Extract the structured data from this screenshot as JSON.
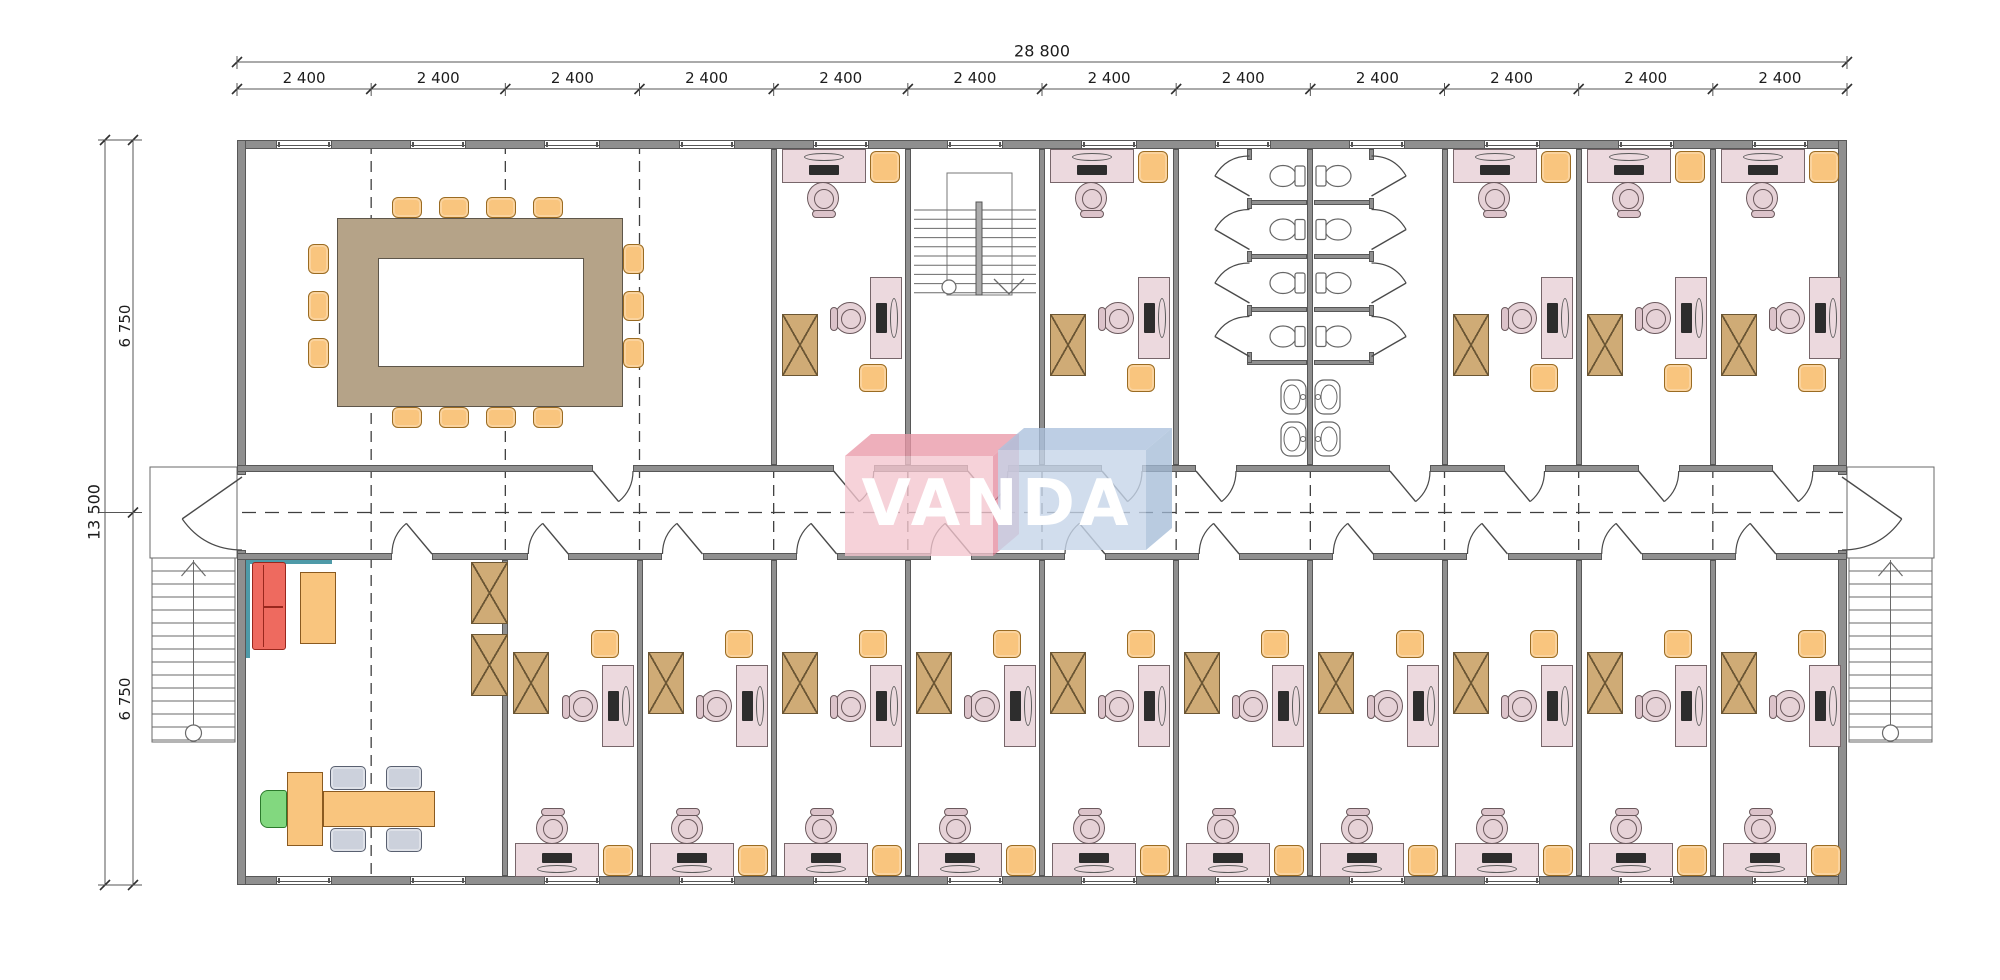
{
  "plan": {
    "logo": {
      "text": "VANDA",
      "box_left_color": "#eba3b1",
      "box_right_color": "#bfd0e6"
    },
    "dimensions": {
      "top_total": "28 800",
      "top_modules": [
        "2 400",
        "2 400",
        "2 400",
        "2 400",
        "2 400",
        "2 400",
        "2 400",
        "2 400",
        "2 400",
        "2 400",
        "2 400",
        "2 400"
      ],
      "left_total": "13 500",
      "left_halves": [
        "6 750",
        "6 750"
      ]
    },
    "rooms": {
      "conference_room": {
        "chairs": 14,
        "table": "ring-table"
      },
      "top_offices": 5,
      "stairwell": 1,
      "toilet_stalls": 8,
      "sinks": 4,
      "reception": 1,
      "bottom_offices": 10,
      "external_stairs": 2
    },
    "colors": {
      "wall": "#8f8f8f",
      "wall_edge": "#575757",
      "desk_pink": "#ecd9de",
      "chair_orange": "#f9c57e",
      "cabinet_tan": "#cfab76",
      "table_tan": "#b5a388",
      "sofa_red": "#ee6a5f",
      "chair_green": "#82d87f",
      "chair_gray": "#ccd1dc",
      "accent_teal": "#4e9aa8",
      "line": "#3f3f3f"
    }
  }
}
